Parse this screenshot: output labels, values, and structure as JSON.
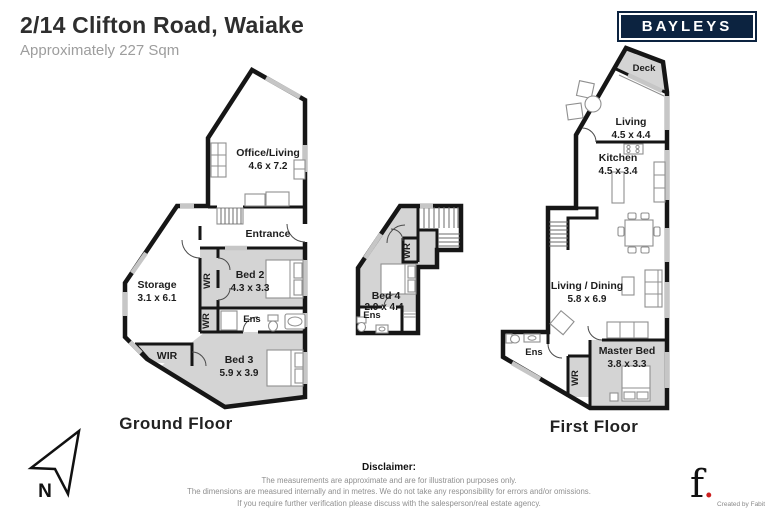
{
  "header": {
    "title": "2/14 Clifton Road, Waiake",
    "subtitle": "Approximately 227 Sqm"
  },
  "brand": {
    "name": "BAYLEYS",
    "navy": "#0c2340"
  },
  "ground_floor": {
    "label": "Ground Floor",
    "rooms": {
      "office_living": {
        "name": "Office/Living",
        "dims": "4.6 x 7.2"
      },
      "entrance": {
        "name": "Entrance"
      },
      "storage": {
        "name": "Storage",
        "dims": "3.1 x 6.1"
      },
      "wr_upper": {
        "name": "WR"
      },
      "bed2": {
        "name": "Bed 2",
        "dims": "4.3 x 3.3"
      },
      "ens": {
        "name": "Ens"
      },
      "wr_lower": {
        "name": "WR"
      },
      "wir": {
        "name": "WIR"
      },
      "bed3": {
        "name": "Bed 3",
        "dims": "5.9 x 3.9"
      }
    }
  },
  "mid_unit": {
    "rooms": {
      "wr": {
        "name": "WR"
      },
      "bed4": {
        "name": "Bed 4",
        "dims": "2.9 x 4.4"
      },
      "ens": {
        "name": "Ens"
      }
    }
  },
  "first_floor": {
    "label": "First Floor",
    "rooms": {
      "deck": {
        "name": "Deck"
      },
      "living": {
        "name": "Living",
        "dims": "4.5 x 4.4"
      },
      "kitchen": {
        "name": "Kitchen",
        "dims": "4.5 x 3.4"
      },
      "living_dining": {
        "name": "Living / Dining",
        "dims": "5.8 x 6.9"
      },
      "ens": {
        "name": "Ens"
      },
      "wr": {
        "name": "WR"
      },
      "master": {
        "name": "Master Bed",
        "dims": "3.8 x 3.3"
      }
    }
  },
  "compass": {
    "label": "N"
  },
  "disclaimer": {
    "heading": "Disclaimer:",
    "lines": [
      "The measurements are approximate and are for illustration purposes only.",
      "The dimensions are measured internally and in metres. We do not take any responsibility for errors and/or omissions.",
      "If you require further verification please discuss with the salesperson/real estate agency."
    ]
  },
  "credit": {
    "logo_letter": "f",
    "logo_dot": ".",
    "label": "Created by Fabit"
  }
}
